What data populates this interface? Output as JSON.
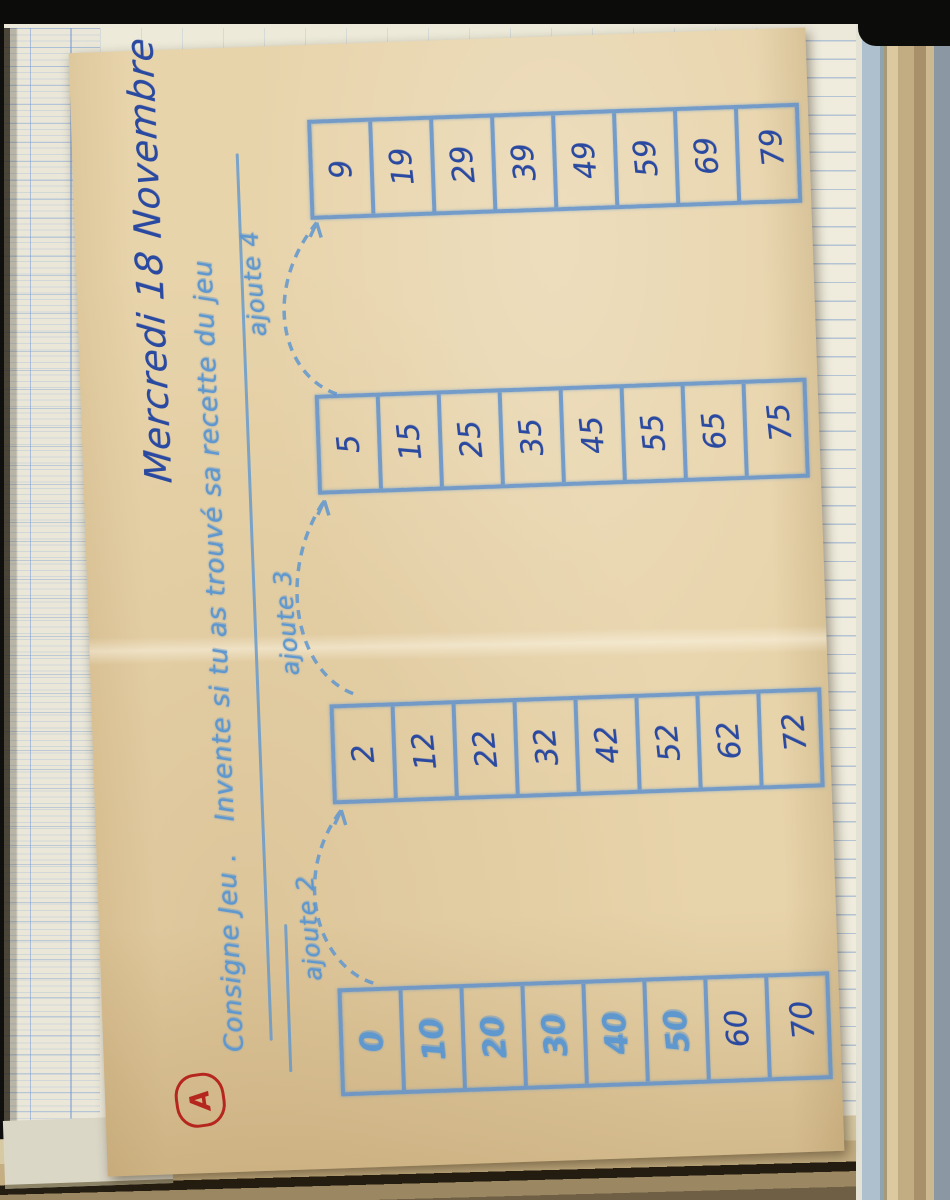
{
  "worksheet": {
    "date_title": "Mercredi 18 Novembre",
    "consigne_label": "Consigne Jeu .",
    "instruction": "Invente si tu as trouvé sa recette du jeu",
    "arrow_labels": [
      "ajoute 2",
      "ajoute 3",
      "ajoute 4"
    ],
    "grade_mark": "A",
    "columns": [
      {
        "values": [
          "0",
          "10",
          "20",
          "30",
          "40",
          "50",
          "60",
          "70"
        ],
        "printed_count": 6
      },
      {
        "values": [
          "2",
          "12",
          "22",
          "32",
          "42",
          "52",
          "62",
          "72"
        ],
        "printed_count": 0
      },
      {
        "values": [
          "5",
          "15",
          "25",
          "35",
          "45",
          "55",
          "65",
          "75"
        ],
        "printed_count": 0
      },
      {
        "values": [
          "9",
          "19",
          "29",
          "39",
          "49",
          "59",
          "69",
          "79"
        ],
        "printed_count": 0
      }
    ],
    "ink": {
      "ditto_blue": "#5f97cf",
      "pen_blue": "#2a49a0",
      "red": "#b5261f"
    }
  }
}
